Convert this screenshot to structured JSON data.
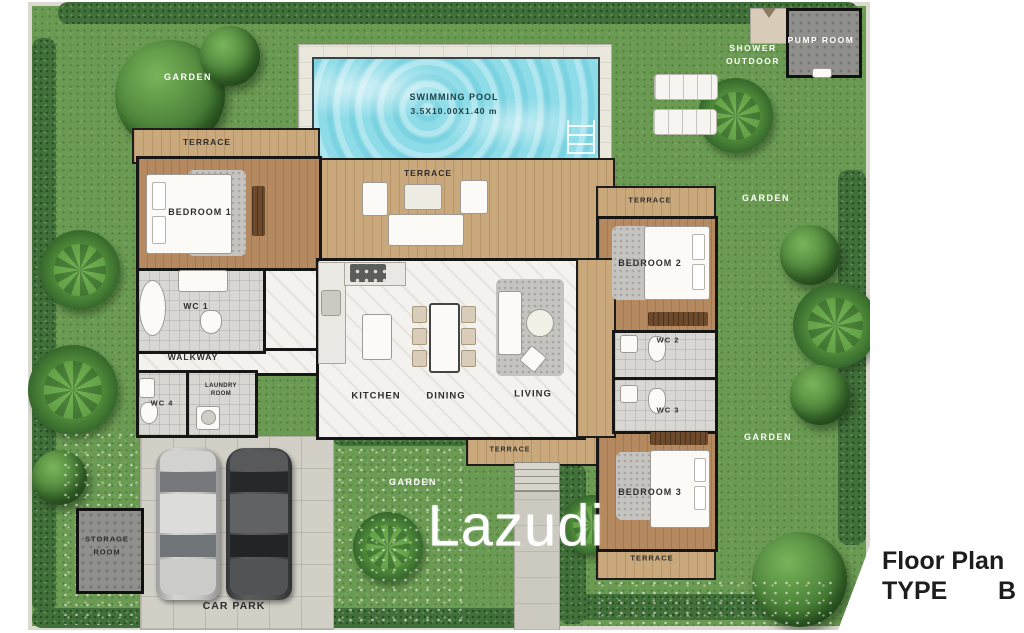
{
  "watermark": "Lazudi",
  "plan_title": {
    "name": "Floor Plan",
    "type_label": "TYPE",
    "type_value": "B"
  },
  "pool": {
    "name": "SWIMMING POOL",
    "dimensions": "3.5X10.00X1.40 m"
  },
  "rooms": {
    "terrace": "TERRACE",
    "garden": "GARDEN",
    "bedroom1": "BEDROOM 1",
    "bedroom2": "BEDROOM 2",
    "bedroom3": "BEDROOM 3",
    "wc1": "WC 1",
    "wc2": "WC 2",
    "wc3": "WC 3",
    "wc4": "WC 4",
    "walkway": "WALKWAY",
    "laundry_line1": "LAUNDRY",
    "laundry_line2": "ROOM",
    "kitchen": "KITCHEN",
    "dining": "DINING",
    "living": "LIVING",
    "storage_line1": "STORAGE",
    "storage_line2": "ROOM",
    "car_park": "CAR PARK",
    "pump_room": "PUMP ROOM",
    "shower_line1": "SHOWER",
    "shower_line2": "OUTDOOR"
  },
  "icons": {
    "pool_ladder": "pool-ladder",
    "shower_pad": "outdoor-shower",
    "washer": "washing-machine"
  },
  "colors": {
    "grass": "#6b9b53",
    "hedge": "#41703a",
    "pool_water": "#8edce8",
    "pool_deck": "#eae7dd",
    "deck_wood": "#c9a87c",
    "room_wood": "#b58a60",
    "marble": "#f3f2ee",
    "tile": "#d8d7d3",
    "concrete": "#d2cfc6",
    "structure": "#8f8f8b",
    "wall": "#161616",
    "label_dark": "#2d2d2d",
    "label_light": "#ffffff"
  }
}
